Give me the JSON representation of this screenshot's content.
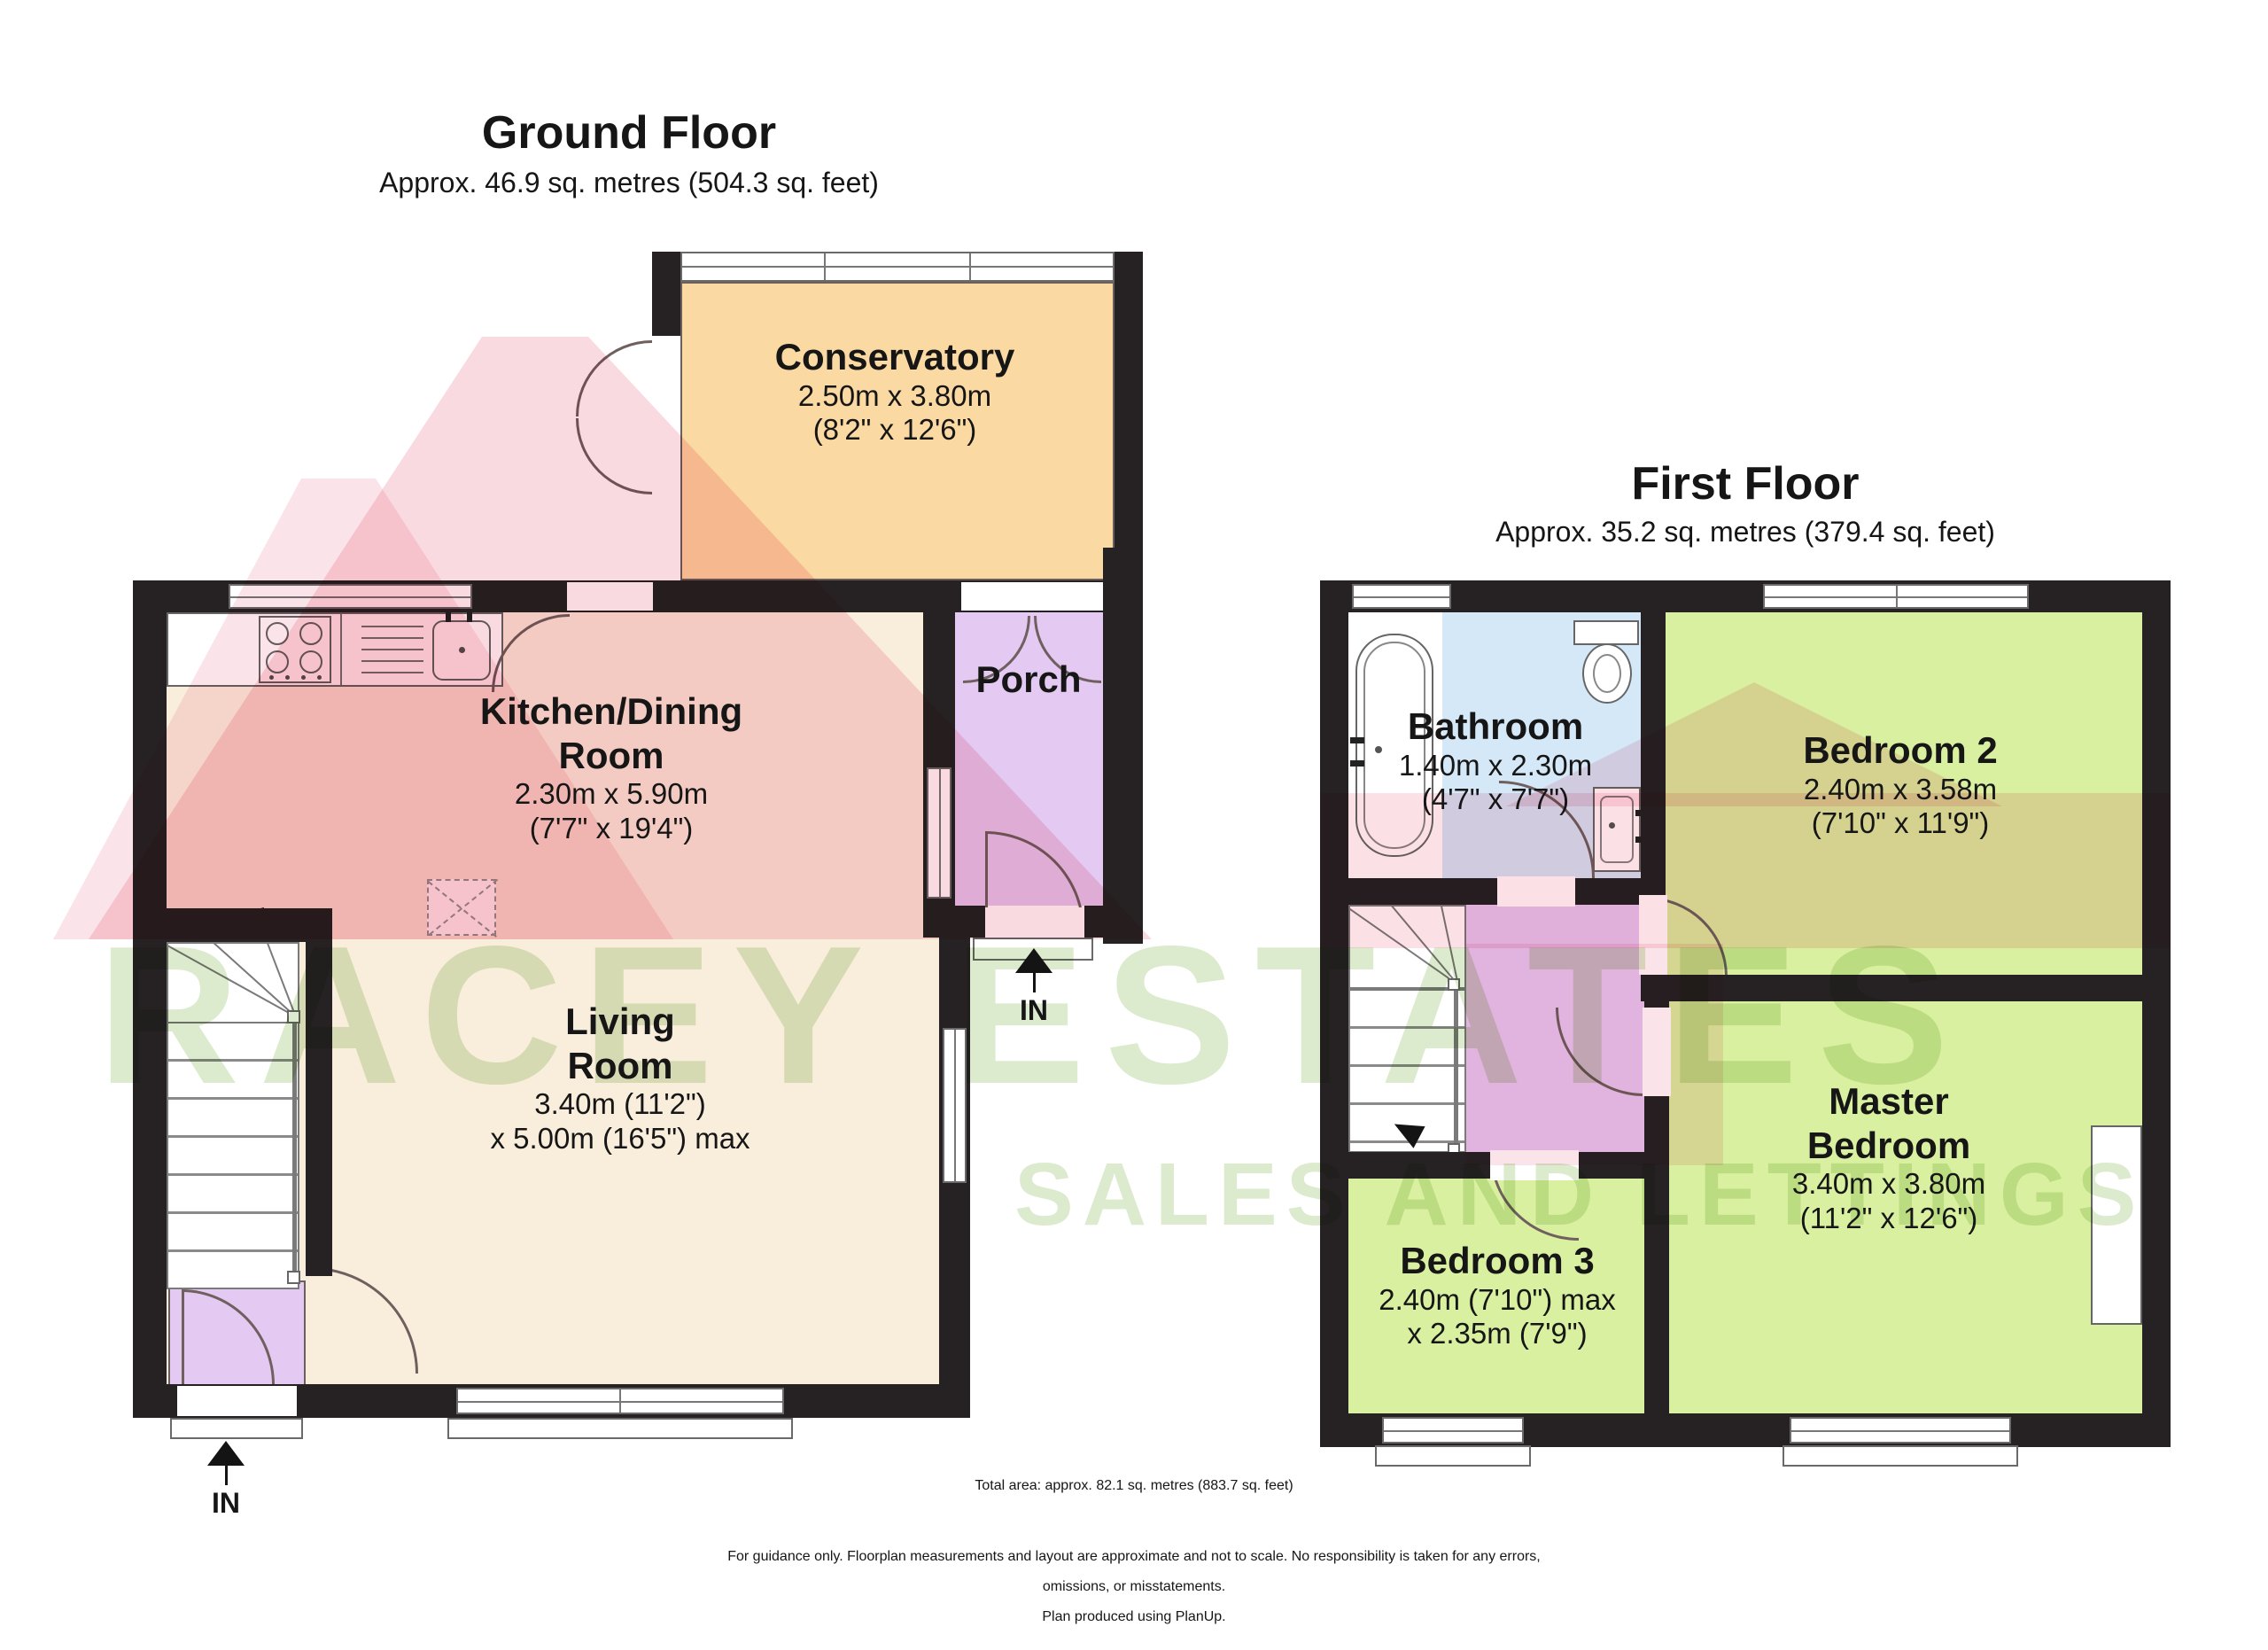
{
  "ground_floor": {
    "title": "Ground Floor",
    "subtitle": "Approx. 46.9 sq. metres (504.3 sq. feet)"
  },
  "first_floor": {
    "title": "First Floor",
    "subtitle": "Approx. 35.2 sq. metres (379.4 sq. feet)"
  },
  "rooms": {
    "conservatory": {
      "name": "Conservatory",
      "dims1": "2.50m x 3.80m",
      "dims2": "(8'2\" x 12'6\")"
    },
    "kitchen": {
      "name1": "Kitchen/Dining",
      "name2": "Room",
      "dims1": "2.30m x 5.90m",
      "dims2": "(7'7\" x 19'4\")"
    },
    "porch": {
      "name": "Porch"
    },
    "living": {
      "name1": "Living",
      "name2": "Room",
      "dims1": "3.40m (11'2\")",
      "dims2": "x 5.00m (16'5\") max"
    },
    "bathroom": {
      "name": "Bathroom",
      "dims1": "1.40m x 2.30m",
      "dims2": "(4'7\" x 7'7\")"
    },
    "bedroom2": {
      "name": "Bedroom 2",
      "dims1": "2.40m x 3.58m",
      "dims2": "(7'10\" x 11'9\")"
    },
    "master": {
      "name1": "Master",
      "name2": "Bedroom",
      "dims1": "3.40m x 3.80m",
      "dims2": "(11'2\" x 12'6\")"
    },
    "bedroom3": {
      "name": "Bedroom 3",
      "dims1": "2.40m (7'10\") max",
      "dims2": "x 2.35m (7'9\")"
    }
  },
  "entrances": {
    "ground": {
      "label": "IN"
    },
    "porch": {
      "label": "IN"
    }
  },
  "watermark": {
    "line1": "RACEY ESTATES",
    "line2": "SALES AND LETTINGS"
  },
  "footer": {
    "total": "Total area: approx. 82.1 sq. metres (883.7 sq. feet)",
    "disclaimer1": "For guidance only. Floorplan measurements and layout are approximate and not to scale. No responsibility is taken for any errors,",
    "disclaimer2": "omissions, or misstatements.",
    "disclaimer3": "Plan produced using PlanUp."
  },
  "colors": {
    "wall": "#262123",
    "cream": "#f9eedc",
    "orange": "#fbd9a2",
    "lavender": "#e4c9f3",
    "blue": "#d4e8f8",
    "green": "#d9f0a0",
    "wm_pink": "#f2a6b6",
    "wm_green": "#a8c983"
  }
}
